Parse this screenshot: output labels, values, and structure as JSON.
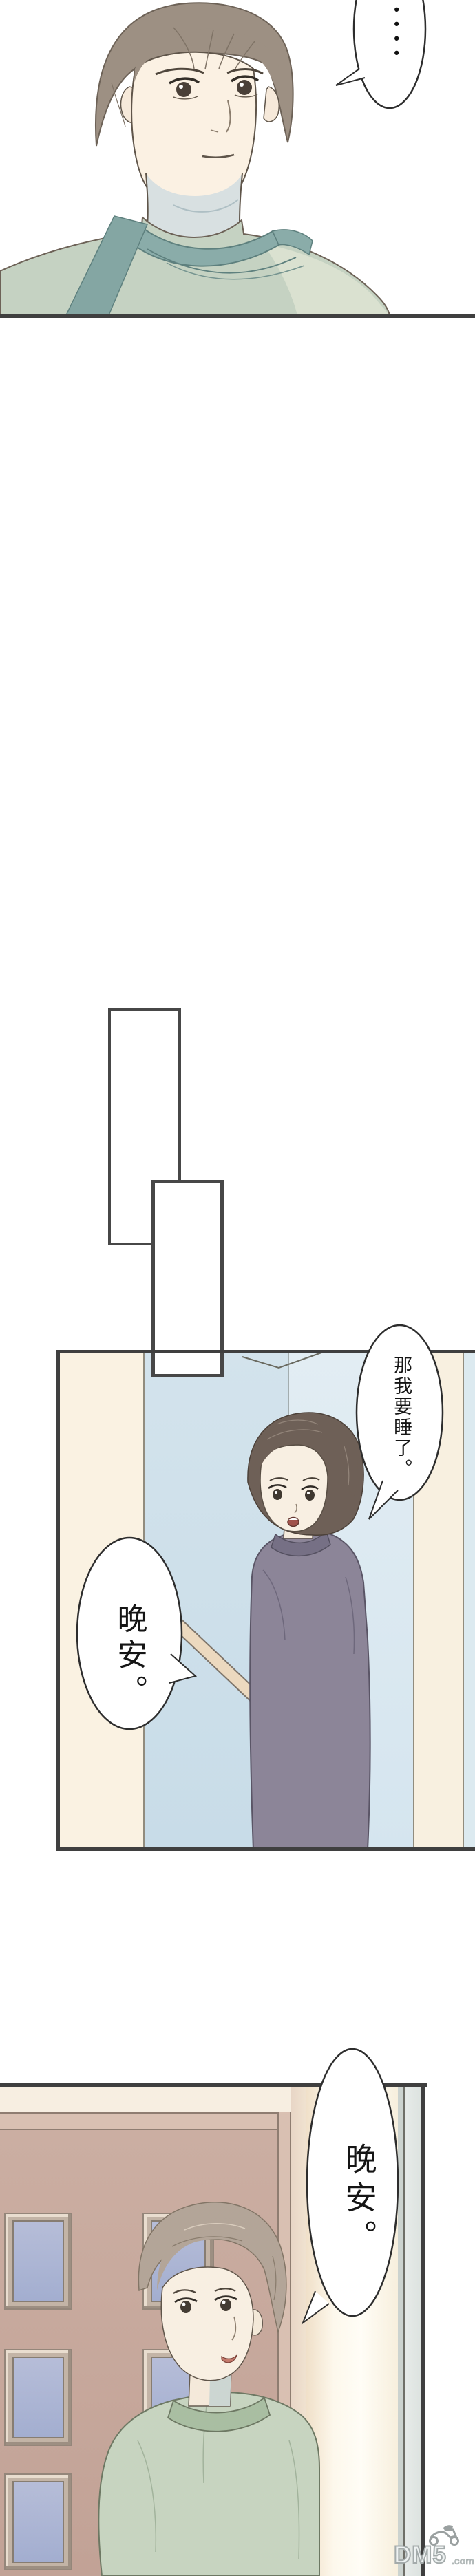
{
  "page_type": "vertical-comic-strip",
  "palette": {
    "panel_border": "#3f3f3f",
    "bubble_outline": "#2d2d2d",
    "cream_wall": "#faf2e2",
    "blue_wall": "#cfe0ea",
    "mauve_wall": "#c9ab9f",
    "window_glass": "#aab3d3",
    "door_light": "#fdf6e8",
    "apron_teal": "#84a6a3",
    "sweater_sage": "#c5d2c2",
    "sweater_purple": "#8c8598",
    "sweater_green": "#c7d4c0",
    "watermark_gray": "#a4abab"
  },
  "panel1": {
    "bubble_ellipsis": {
      "text": "••••"
    }
  },
  "panel3": {
    "bubble_top_right": {
      "text": "那我要睡了。"
    },
    "bubble_left": {
      "text": "晚安。"
    }
  },
  "panel4": {
    "bubble": {
      "text": "晚安。"
    }
  },
  "watermark": {
    "brand": "DM5",
    "suffix": ".com",
    "icon": "scooter-icon"
  }
}
